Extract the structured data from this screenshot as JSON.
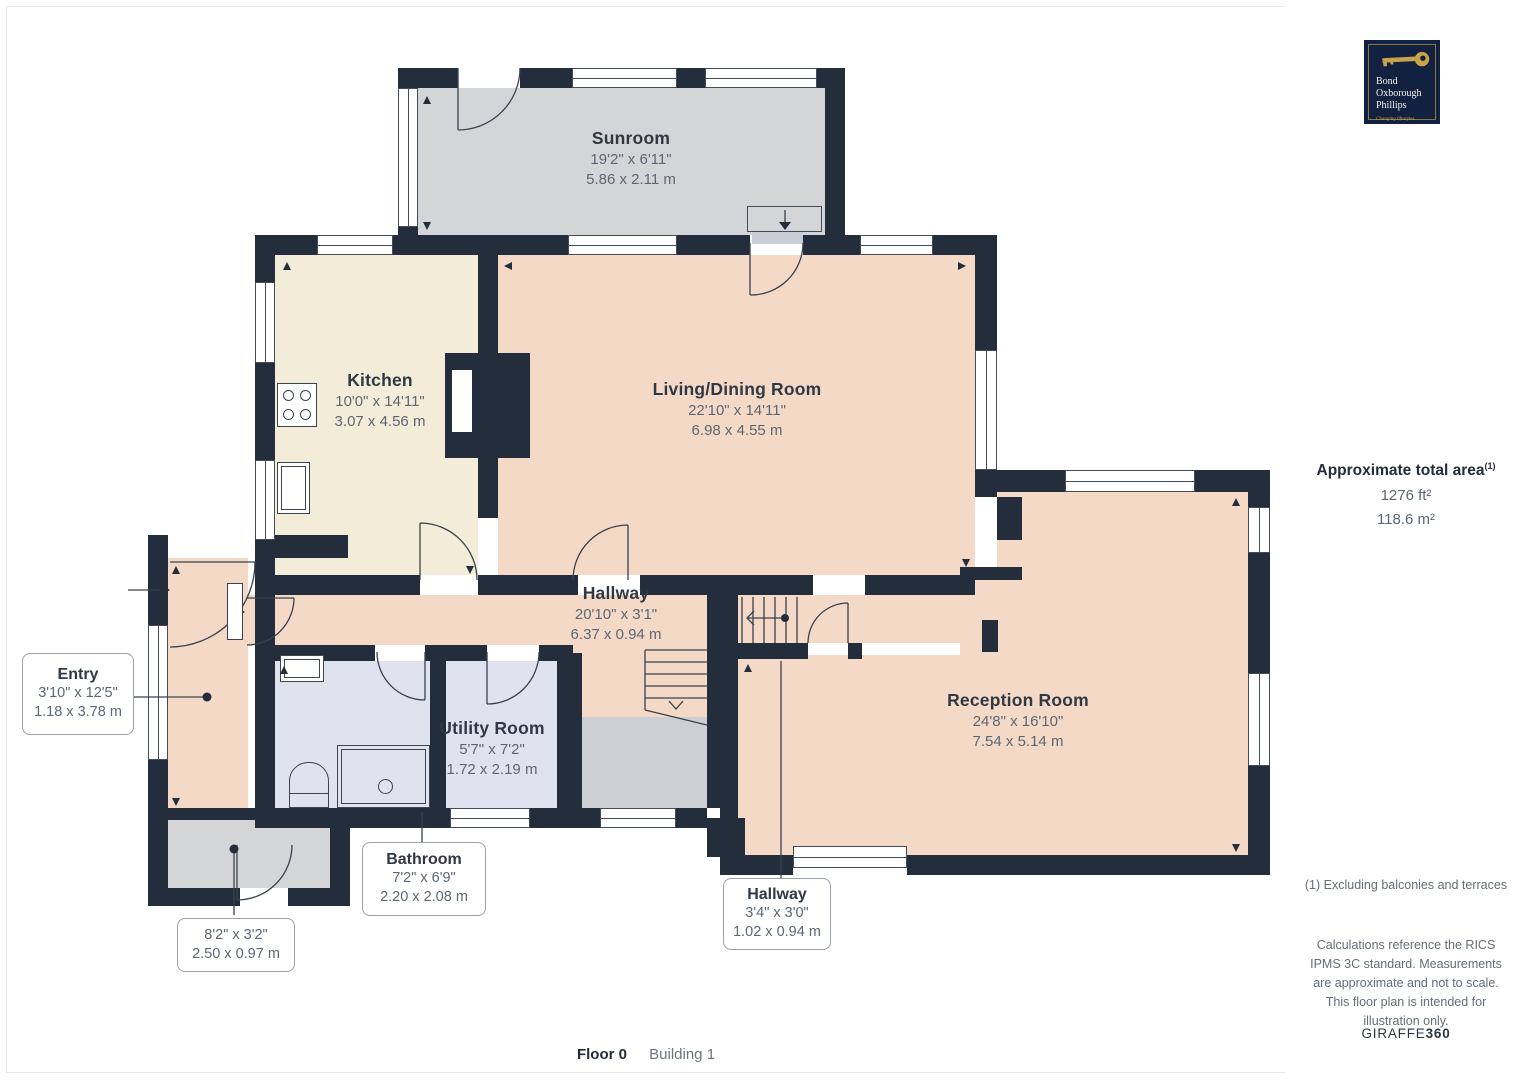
{
  "rooms": {
    "sunroom": {
      "name": "Sunroom",
      "imperial": "19'2\" x 6'11\"",
      "metric": "5.86 x 2.11 m"
    },
    "kitchen": {
      "name": "Kitchen",
      "imperial": "10'0\" x 14'11\"",
      "metric": "3.07 x 4.56 m"
    },
    "living": {
      "name": "Living/Dining Room",
      "imperial": "22'10\" x 14'11\"",
      "metric": "6.98 x 4.55 m"
    },
    "hallway": {
      "name": "Hallway",
      "imperial": "20'10\" x 3'1\"",
      "metric": "6.37 x 0.94 m"
    },
    "utility": {
      "name": "Utility Room",
      "imperial": "5'7\" x 7'2\"",
      "metric": "1.72 x 2.19 m"
    },
    "reception": {
      "name": "Reception Room",
      "imperial": "24'8\" x 16'10\"",
      "metric": "7.54 x 5.14 m"
    }
  },
  "callouts": {
    "entry": {
      "name": "Entry",
      "imperial": "3'10\" x 12'5\"",
      "metric": "1.18 x 3.78 m"
    },
    "bathroom": {
      "name": "Bathroom",
      "imperial": "7'2\" x 6'9\"",
      "metric": "2.20 x 2.08 m"
    },
    "porch": {
      "imperial": "8'2\" x 3'2\"",
      "metric": "2.50 x 0.97 m"
    },
    "hallway_small": {
      "name": "Hallway",
      "imperial": "3'4\" x 3'0\"",
      "metric": "1.02 x 0.94 m"
    }
  },
  "sidebar": {
    "logo": {
      "line1": "Bond",
      "line2": "Oxborough",
      "line3": "Phillips",
      "tagline": "Changing lifestyles"
    },
    "area": {
      "title": "Approximate total area",
      "sup": "(1)",
      "imperial": "1276 ft²",
      "metric": "118.6 m²"
    },
    "footnote": "(1) Excluding balconies and terraces",
    "disclaimer": "Calculations reference the RICS IPMS 3C standard. Measurements are approximate and not to scale. This floor plan is intended for illustration only.",
    "brand": {
      "name": "GIRAFFE",
      "suffix": "360"
    }
  },
  "footer": {
    "floor": "Floor 0",
    "building": "Building 1"
  },
  "colors": {
    "wall": "#232d3b",
    "room_pink": "#f5d9c7",
    "room_cream": "#f2ecd8",
    "room_blue": "#dfe3ee",
    "room_gray": "#d4d5d6",
    "landing_gray": "#ccd0d5",
    "logo_navy": "#12213f",
    "logo_gold": "#c8a34b",
    "line": "#39424e",
    "title_text": "#2f3945",
    "dim_text": "#5d6774"
  },
  "icons": [
    "key-icon",
    "stove-icon",
    "sink-icon",
    "toilet-icon",
    "shower-icon",
    "stairs-icon",
    "entrance-arrow-icon",
    "door-arc-icon"
  ]
}
